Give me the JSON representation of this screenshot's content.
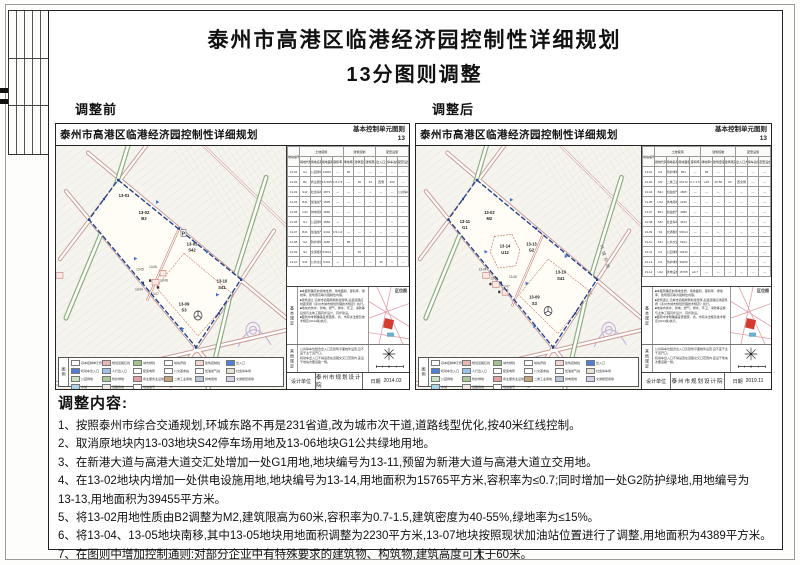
{
  "page": {
    "title_line1": "泰州市高港区临港经济园控制性详细规划",
    "title_line2": "13分图则调整",
    "label_before": "调整前",
    "label_after": "调整后"
  },
  "panel_common": {
    "map_title": "泰州市高港区临港经济园控制性详细规划",
    "sheet_label": "基本控制单元图则",
    "sheet_no": "13",
    "legend_title": "图例",
    "location_map_label": "区位图",
    "designer_label": "设计单位",
    "designer": "泰州市规划设计院",
    "date_label": "日期"
  },
  "table_header": {
    "col0": "地块编号",
    "groups": [
      "土地使用",
      "建筑控制",
      "配套设施"
    ],
    "cols": [
      "用地代码",
      "用地名称",
      "用地面积(m²)",
      "容积率",
      "绿地率(%)",
      "建筑密度(%)",
      "建筑限高(m)",
      "出入口方位",
      "停车泊位",
      "配套设施"
    ]
  },
  "before": {
    "date": "2014.03",
    "map_labels": {
      "lbl_02": "13-02",
      "code_02": "B2",
      "lbl_03": "13-03",
      "code_03": "S42",
      "lbl_09": "13-09",
      "code_09": "S3",
      "lbl_10": "13-10",
      "code_10": "S41",
      "lbl_01": "13-01",
      "lbl_04": "13-04",
      "lbl_05": "13-05",
      "lbl_06": "13-06",
      "lbl_07": "13-07",
      "lbl_08": "13-08",
      "p_mark": "P"
    },
    "table_rows": [
      [
        "13-01",
        "G1",
        "公园绿地",
        "13466",
        "—",
        "65",
        "—",
        "—",
        "—",
        "—",
        "—"
      ],
      [
        "13-02",
        "B2",
        "商业服务用地",
        "147465",
        "1.0-2.5",
        "—",
        "30",
        "24",
        "西侧",
        "200",
        "—"
      ],
      [
        "13-03",
        "S42",
        "社会停车场用地",
        "4873",
        "—",
        "—",
        "—",
        "—",
        "—",
        "—",
        "公共停车"
      ],
      [
        "13-04",
        "B41",
        "加油加气站用地",
        "1805",
        "—",
        "—",
        "—",
        "—",
        "—",
        "—",
        "—"
      ],
      [
        "13-05",
        "U12",
        "供电用地",
        "1860",
        "—",
        "—",
        "—",
        "—",
        "—",
        "—",
        "—"
      ],
      [
        "13-06",
        "G1",
        "公园绿地",
        "1860",
        "—",
        "—",
        "—",
        "—",
        "—",
        "—",
        "—"
      ],
      [
        "13-07",
        "B41",
        "加油加气站用地",
        "3404",
        "0.5-1.0",
        "—",
        "—",
        "—",
        "—",
        "—",
        "—"
      ],
      [
        "13-08",
        "G2",
        "防护绿地",
        "4066",
        "—",
        "85",
        "—",
        "—",
        "—",
        "—",
        "—"
      ],
      [
        "13-09",
        "S3",
        "交通枢纽用地",
        "53014",
        "—",
        "—",
        "40",
        "—",
        "—",
        "—",
        "—"
      ],
      [
        "13-10",
        "S41",
        "公共交通场站用地",
        "5404",
        "—",
        "—",
        "—",
        "—",
        "45",
        "—",
        "—"
      ]
    ]
  },
  "after": {
    "date": "2019.11",
    "road_label": "环城东路",
    "map_labels": {
      "lbl_02": "13-02",
      "code_02": "M2",
      "lbl_14": "13-14",
      "code_14": "U12",
      "lbl_13": "13-13",
      "code_13": "G2",
      "lbl_11": "13-11",
      "code_11": "G1",
      "lbl_09": "13-09",
      "code_09": "S3",
      "lbl_10": "13-10",
      "code_10": "S41",
      "lbl_04": "13-04",
      "lbl_05": "13-05",
      "lbl_07": "13-07",
      "lbl_08": "13-08"
    },
    "table_rows": [
      [
        "13-01",
        "G2",
        "防护绿地",
        "851",
        "—",
        "85",
        "—",
        "—",
        "—",
        "—",
        "—"
      ],
      [
        "13-02",
        "M2",
        "二类工业用地",
        "63172",
        "0.7-1.5",
        "≤15",
        "40-55",
        "60",
        "西北侧",
        "—",
        "—"
      ],
      [
        "13-04",
        "B41",
        "加油加气站用地",
        "1805",
        "—",
        "—",
        "—",
        "—",
        "—",
        "—",
        "—"
      ],
      [
        "13-05",
        "U12",
        "供电用地",
        "2230",
        "—",
        "—",
        "—",
        "—",
        "—",
        "—",
        "—"
      ],
      [
        "13-07",
        "B41",
        "加油加气站用地",
        "4389",
        "—",
        "—",
        "—",
        "—",
        "—",
        "—",
        "—"
      ],
      [
        "13-08",
        "S42",
        "社会停车场用地",
        "3014",
        "—",
        "—",
        "—",
        "—",
        "—",
        "—",
        "—"
      ],
      [
        "13-09",
        "S3",
        "交通枢纽用地",
        "53014",
        "—",
        "—",
        "—",
        "—",
        "—",
        "—",
        "—"
      ],
      [
        "13-10",
        "S41",
        "公共交通场站用地",
        "5404",
        "—",
        "—",
        "—",
        "—",
        "—",
        "—",
        "—"
      ],
      [
        "13-11",
        "G1",
        "公园绿地",
        "10432",
        "—",
        "—",
        "—",
        "—",
        "—",
        "—",
        "—"
      ],
      [
        "13-13",
        "G2",
        "防护绿地",
        "39455",
        "—",
        "—",
        "—",
        "—",
        "—",
        "—",
        "—"
      ],
      [
        "13-14",
        "U12",
        "供电设施用地",
        "15765",
        "≤0.7",
        "—",
        "—",
        "—",
        "—",
        "—",
        "—"
      ]
    ]
  },
  "regulations": {
    "basic_label": "基本规定",
    "other_label": "其他规定",
    "basic": [
      "■本图则确定的用地性质、用地面积、容积率、绿地率、建筑限高等为强制性内容。",
      "■建筑退让:沿城市道路两侧新建建筑,后退道路红线距离按《泰州市城市规划管理技术规定》执行。",
      "■地块内供水、供电、燃气、排水、环卫、消防等设施与主体工程同步设计、同步建设。",
      "■图则中未明确事宜按国家、省、市有关法规及技术规定(2014版)执行。"
    ],
    "other": [
      "公共停车位结合出入口及建筑平面统筹设置,且不宜于主干道开口。",
      "机动车出入口不得设置在道路交叉口范围内,宜设于地块次要道路一侧。"
    ]
  },
  "legend_items": [
    {
      "label": "基本控制单元界线",
      "color": "#ffffff"
    },
    {
      "label": "规划道路红线",
      "color": "#e9b8b0"
    },
    {
      "label": "城市绿线",
      "color": "#9fc48e"
    },
    {
      "label": "地块界线",
      "color": "#ffffff"
    },
    {
      "label": "建筑控制线",
      "color": "#f6d7d2"
    },
    {
      "label": "出入口",
      "color": "#4f7fd9"
    },
    {
      "label": "机动车出入口",
      "color": "#4f7fd9"
    },
    {
      "label": "人行出入口",
      "color": "#9fc3e8"
    },
    {
      "label": "配变电所",
      "color": "#ffffff"
    },
    {
      "label": "公交首末站",
      "color": "#ffffff"
    },
    {
      "label": "加油加气站",
      "color": "#ffffff"
    },
    {
      "label": "社会停车场",
      "color": "#e8e3d5"
    },
    {
      "label": "公园绿地",
      "color": "#cde3bd"
    },
    {
      "label": "防护绿地",
      "color": "#a8c89a"
    },
    {
      "label": "商业服务业设施用地",
      "color": "#e8a0a0"
    },
    {
      "label": "二类工业用地",
      "color": "#c7a27c"
    },
    {
      "label": "供电用地",
      "color": "#b8c8d8"
    },
    {
      "label": "交通枢纽用地",
      "color": "#d8d0e8"
    },
    {
      "label": "水域",
      "color": "#aad4ea"
    },
    {
      "label": "道路用地",
      "color": "#f0e8e0"
    },
    {
      "label": "地块编号",
      "color": "#ffffff"
    }
  ],
  "adjustments": {
    "heading": "调整内容:",
    "items": [
      "1、按照泰州市综合交通规划,环城东路不再是231省道,改为城市次干道,道路线型优化,按40米红线控制。",
      "2、取消原地块内13-03地块S42停车场用地及13-06地块G1公共绿地用地。",
      "3、在新港大道与高港大道交汇处增加一处G1用地,地块编号为13-11,预留为新港大道与高港大道立交用地。",
      "4、在13-02地块内增加一处供电设施用地,地块编号为13-14,用地面积为15765平方米,容积率为≤0.7;同时增加一处G2防护绿地,用地编号为\n13-13,用地面积为39455平方米。",
      "5、将13-02用地性质由B2调整为M2,建筑限高为60米,容积率为0.7-1.5,建筑密度为40-55%,绿地率为≤15%。",
      "6、将13-04、13-05地块南移,其中13-05地块用地面积调整为2230平方米,13-07地块按照现状加油站位置进行了调整,用地面积为4389平方米。",
      "7、在图则中增加控制通则:对部分企业中有特殊要求的建筑物、构筑物,建筑高度可大于60米。"
    ]
  }
}
